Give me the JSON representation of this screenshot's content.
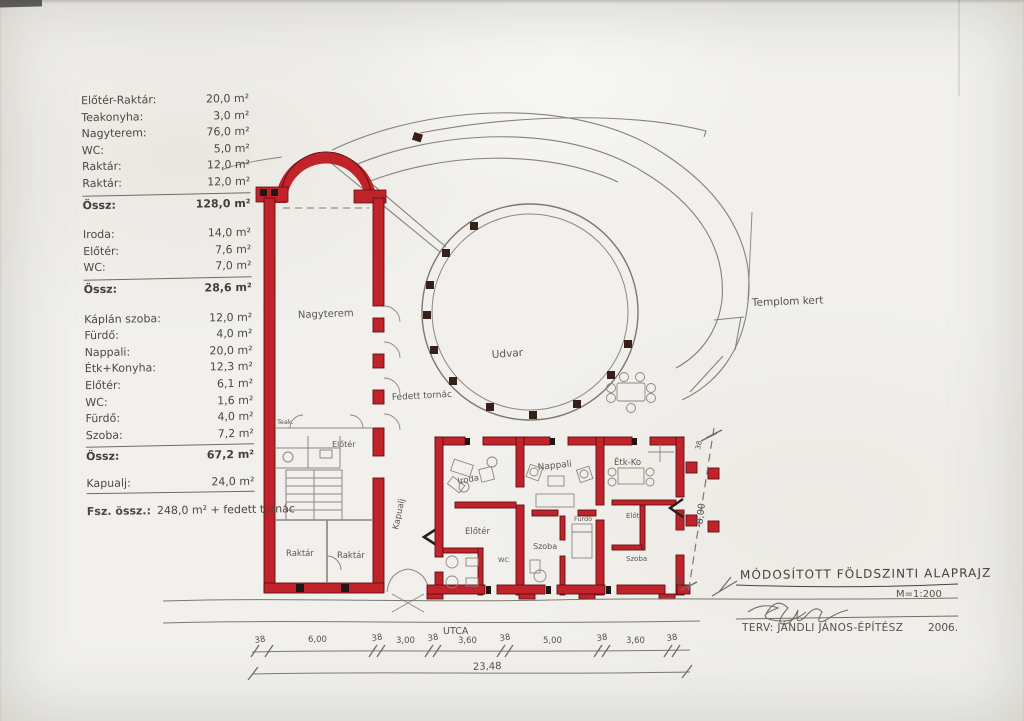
{
  "document": {
    "type": "hand-drawn architectural floor plan (scan)",
    "language": "Hungarian"
  },
  "colors": {
    "paper": "#f1f0ec",
    "pencil": "#7b786e",
    "ink": "#45423a",
    "wall_red": "#c1232b",
    "wall_outline": "#5f0f12",
    "post_dark": "#38201a"
  },
  "schedule": {
    "groups": [
      {
        "items": [
          {
            "label": "Előtér-Raktár:",
            "value": "20,0 m²"
          },
          {
            "label": "Teakonyha:",
            "value": "3,0 m²"
          },
          {
            "label": "Nagyterem:",
            "value": "76,0 m²"
          },
          {
            "label": "WC:",
            "value": "5,0 m²"
          },
          {
            "label": "Raktár:",
            "value": "12,0 m²"
          },
          {
            "label": "Raktár:",
            "value": "12,0 m²"
          }
        ],
        "total": {
          "label": "Össz:",
          "value": "128,0 m²"
        }
      },
      {
        "items": [
          {
            "label": "Iroda:",
            "value": "14,0 m²"
          },
          {
            "label": "Előtér:",
            "value": "7,6 m²"
          },
          {
            "label": "WC:",
            "value": "7,0 m²"
          }
        ],
        "total": {
          "label": "Össz:",
          "value": "28,6 m²"
        }
      },
      {
        "items": [
          {
            "label": "Káplán szoba:",
            "value": "12,0 m²"
          },
          {
            "label": "Fürdő:",
            "value": "4,0 m²"
          },
          {
            "label": "Nappali:",
            "value": "20,0 m²"
          },
          {
            "label": "Étk+Konyha:",
            "value": "12,3 m²"
          },
          {
            "label": "Előtér:",
            "value": "6,1 m²"
          },
          {
            "label": "WC:",
            "value": "1,6 m²"
          },
          {
            "label": "Fürdő:",
            "value": "4,0 m²"
          },
          {
            "label": "Szoba:",
            "value": "7,2 m²"
          }
        ],
        "total": {
          "label": "Össz:",
          "value": "67,2 m²"
        }
      }
    ],
    "kapualj": {
      "label": "Kapualj:",
      "value": "24,0 m²"
    },
    "grand_total": {
      "label": "Fsz. össz.:",
      "value": "248,0 m² + fedett tornác"
    }
  },
  "plan": {
    "labels": {
      "nagyterem": "Nagyterem",
      "teak": "Teak.",
      "eloter_tall": "Előtér",
      "raktar_a": "Raktár",
      "raktar_b": "Raktár",
      "kapualj": "Kapualj",
      "iroda": "Iroda",
      "eloter_a": "Előtér",
      "wc_a": "WC",
      "nappali": "Nappali",
      "szoba_b": "Szoba",
      "furdo_b": "Fürdő",
      "etk_ko": "Étk-Ko",
      "elot_c": "Előt.",
      "szoba_c": "Szoba",
      "udvar": "Udvar",
      "fedett_tornac": "Fedett tornác",
      "templom_kert": "Templom kert"
    },
    "offset_dim": "-8,00",
    "offset_tick": "38"
  },
  "dimensions": {
    "street": "UTCA",
    "segments": [
      "38",
      "6,00",
      "38",
      "3,00",
      "38",
      "3,60",
      "38",
      "5,00",
      "38",
      "3,60",
      "38"
    ],
    "total": "23,48"
  },
  "title_block": {
    "title": "MÓDOSÍTOTT FÖLDSZINTI ALAPRAJZ",
    "scale": "M=1:200",
    "designer": "TERV: JÁNDLI JÁNOS-ÉPÍTÉSZ",
    "year": "2006."
  }
}
